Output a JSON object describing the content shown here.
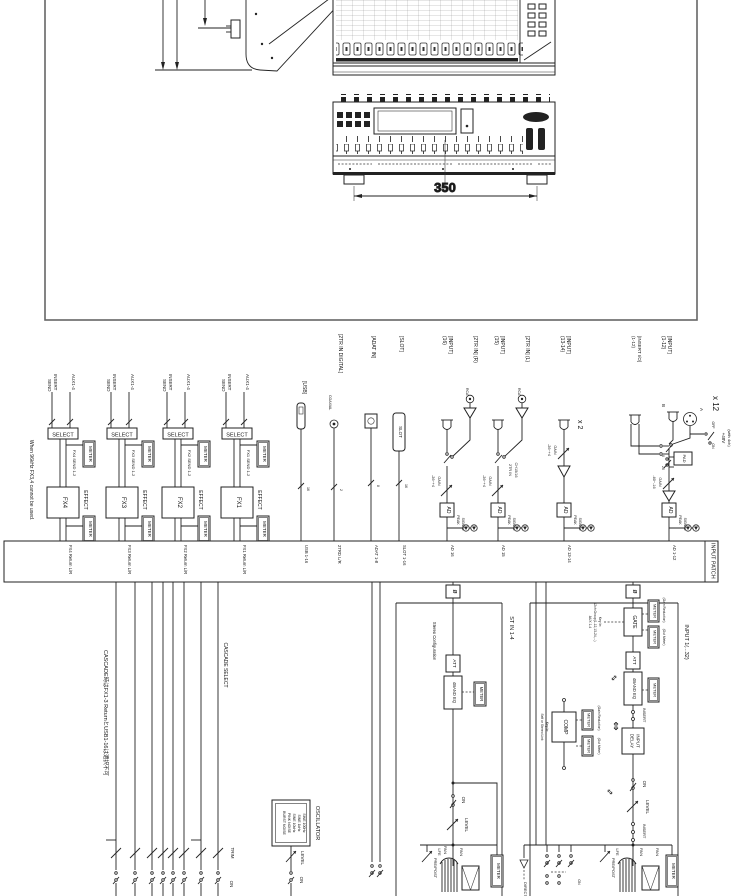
{
  "frame": {
    "dim": "350"
  },
  "d": {
    "meter": "METER",
    "ad": "AD",
    "phase": "ø",
    "swap": "⇕",
    "note96k": "When 96kHz FX3,4 cannot be used.",
    "fxl": {
      "insert": "INSERT",
      "send": "SEND",
      "aux": "AUX1-4",
      "select": "SELECT",
      "effect": "EFFECT"
    },
    "fx": [
      {
        "name": "FX4",
        "send": "FX4 SEND 1-2",
        "ret": "FX4 Return L/R"
      },
      {
        "name": "FX3",
        "send": "FX3 SEND 1-2",
        "ret": "FX3 Return L/R"
      },
      {
        "name": "FX2",
        "send": "FX2 SEND 1-2",
        "ret": "FX2 Return L/R"
      },
      {
        "name": "FX1",
        "send": "FX1 SEND 1-2",
        "ret": "FX1 Return L/R"
      }
    ],
    "usb": {
      "label": "[USB]",
      "n": "16",
      "bus": "USB 1-16"
    },
    "dig": {
      "label": "[2TR IN DIGITAL]",
      "coax": "COAXIAL",
      "n": "2",
      "bus": "2TRD L/R"
    },
    "adat": {
      "label": "[ADAT IN]",
      "n": "8",
      "bus": "ADAT 1-8"
    },
    "slot": {
      "label": "[SLOT]",
      "box": "SLOT",
      "n": "16",
      "bus": "SLOT 1-16"
    },
    "in16": {
      "l1": "[INPUT]",
      "l2": "(16)",
      "bus": "AD 16"
    },
    "in15": {
      "l1": "[INPUT]",
      "l2": "(15)",
      "bus": "AD 15"
    },
    "tr_r": {
      "label": "[2TR IN] (R)",
      "rca": "RCA"
    },
    "tr_l": {
      "label": "[2TR IN] (L)",
      "rca": "RCA"
    },
    "note1516": {
      "l1": "CH15/16",
      "l2": "2TR IN"
    },
    "in1314": {
      "l1": "[INPUT]",
      "l2": "(13-14)",
      "x": "x 2",
      "bus": "AD 13-14"
    },
    "insio": {
      "l1": "[INSERT I/O]",
      "l2": "(1-12)"
    },
    "in112": {
      "l1": "[INPUT]",
      "l2": "(1-12)",
      "x": "x 12",
      "a": "A",
      "b": "B",
      "bus": "AD 1-12"
    },
    "p48": {
      "v": "+48V",
      "sub": "(with 4ch)",
      "on": "ON",
      "off": "OFF"
    },
    "pad": {
      "label": "PAD",
      "p0": "0",
      "p26": "26"
    },
    "gain1316": {
      "l1": "GAIN",
      "l2": "-26~+4"
    },
    "gain112": {
      "l1": "GAIN",
      "l2": "-60~-16"
    },
    "peak": "PEAK",
    "signal": "SIGNAL",
    "patch": "INPUT PATCH",
    "cascade": {
      "jp": "CASCADE時はFX1-3 ReturnとUSB1-16は選択不可",
      "label": "CASCADE SELECT",
      "trim": "TRIM",
      "on": "ON"
    },
    "osc": {
      "label": "OSCILLATOR",
      "l1": "SINE 100Hz",
      "l2": "SINE 1kHz",
      "l3": "SINE 10kHz",
      "l4": "PINK NOISE",
      "l5": "BURST NOISE",
      "level": "LEVEL",
      "on": "ON"
    },
    "st": {
      "label": "ST IN 1-4",
      "cfg": "Stereo Configuration",
      "att": "ATT",
      "eq": "4BAND EQ",
      "on": "ON",
      "level": "LEVEL"
    },
    "ch": {
      "label": "INPUT 1(...32)",
      "gate": "GATE",
      "gr": "(Gain Reduction)",
      "om": "(Out Meter)",
      "k1": "Key In:",
      "k2": "12ch Group(1-12,13-24,...)",
      "k3": "AUX 1-4",
      "att": "ATT",
      "eq": "4BAND EQ",
      "insert": "INSERT",
      "d1": "INPUT",
      "d2": "DELAY",
      "comp": "COMP",
      "ck1": "Key In:",
      "ck2": "Self or Stereo Link",
      "on": "ON",
      "level": "LEVEL"
    },
    "strip": {
      "prepost": "PRE/POST",
      "lfe": "LFE",
      "pan": "PAN",
      "direct": "DIRECT",
      "on": "ON"
    }
  }
}
